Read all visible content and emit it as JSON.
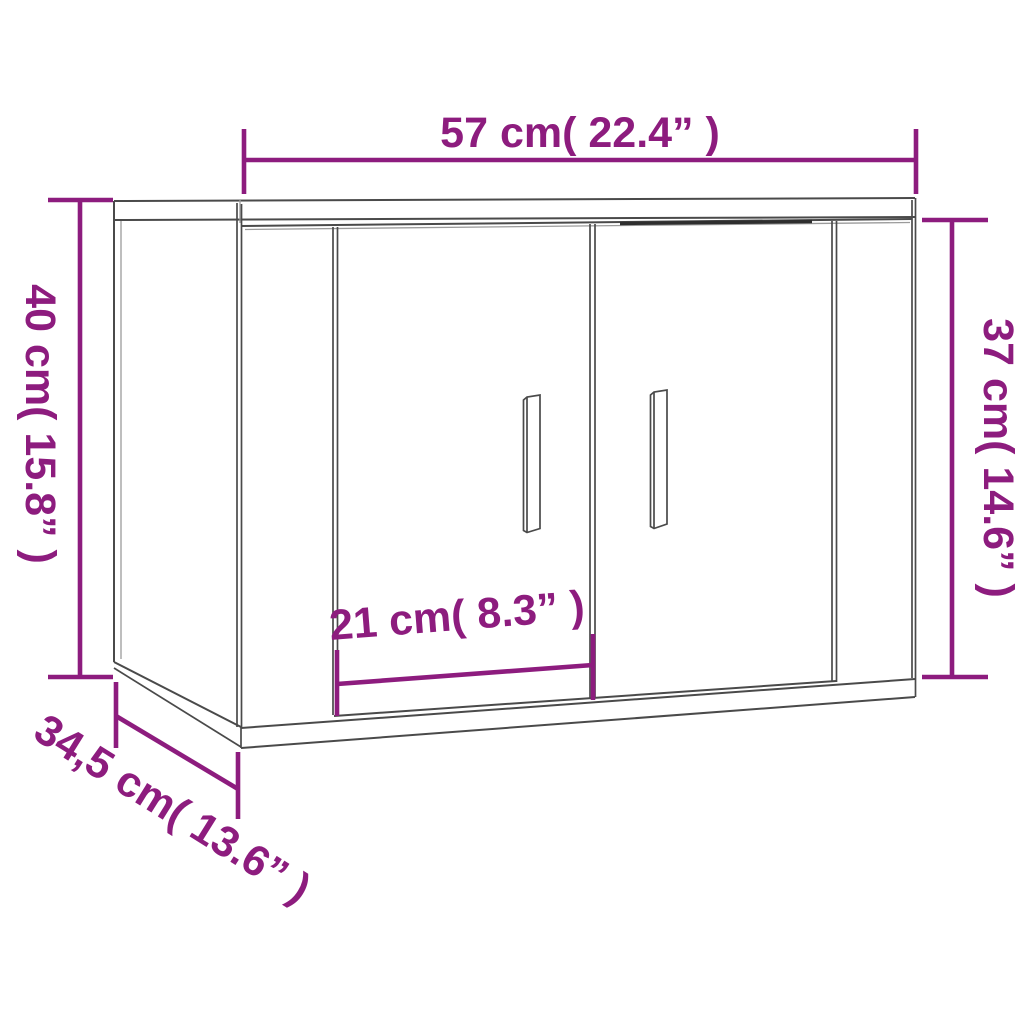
{
  "page": {
    "kind": "product-dimension-diagram",
    "subject": "wall-mounted cabinet with two doors, shown in perspective line drawing"
  },
  "colors": {
    "accent": "#8D1C7E",
    "line": "#4A4A4A",
    "line_light": "#9B9B9B",
    "line_shadow": "#2E2E2E",
    "background": "#FFFFFF"
  },
  "dimensions": {
    "width": {
      "cm": "57",
      "inches": "22.4",
      "label": "57 cm( 22.4” )"
    },
    "height": {
      "cm": "40",
      "inches": "15.8",
      "label": "40 cm( 15.8” )"
    },
    "door_height": {
      "cm": "37",
      "inches": "14.6",
      "label": "37 cm( 14.6” )"
    },
    "door_width": {
      "cm": "21",
      "inches": "8.3",
      "label": "21 cm( 8.3” )"
    },
    "depth": {
      "cm": "34,5",
      "inches": "13.6",
      "label": "34,5 cm( 13.6” )"
    }
  }
}
